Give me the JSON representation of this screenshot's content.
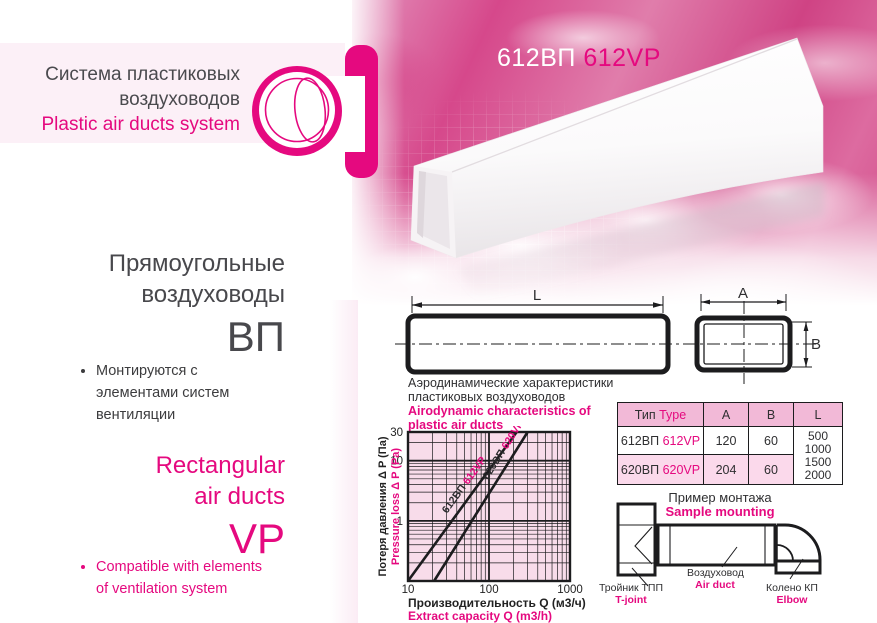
{
  "colors": {
    "accent": "#e5097f",
    "heading": "#48484c",
    "line_dark": "#1c1c1e",
    "plot_bg": "#f8dcea",
    "table_header_bg": "#f2b9d7",
    "table_row_alt_bg": "#fbd9eb",
    "sky_pink": "#d6488b"
  },
  "brand": {
    "title_ru_1": "Система пластиковых",
    "title_ru_2": "воздуховодов",
    "title_en": "Plastic air ducts system"
  },
  "product": {
    "code_ru": "612ВП",
    "code_en": "612VP"
  },
  "left_column": {
    "heading_ru_1": "Прямоугольные",
    "heading_ru_2": "воздуховоды",
    "type_ru": "ВП",
    "bullet_ru": "Монтируются с элементами систем вентиляции",
    "heading_en_1": "Rectangular",
    "heading_en_2": "air ducts",
    "type_en": "VP",
    "bullet_en": "Compatible with elements of ventilation system"
  },
  "dimensions": {
    "length_label": "L",
    "width_label": "A",
    "height_label": "B"
  },
  "chart_data": {
    "type": "line",
    "title_ru": [
      "Аэродинамические характеристики",
      "пластиковых воздуховодов"
    ],
    "title_en": [
      "Airodynamic characteristics of",
      "plastic air ducts"
    ],
    "xlabel_ru": "Производительность Q (м3/ч)",
    "xlabel_en": "Extract capacity Q (m3/h)",
    "ylabel_ru": "Потеря давления Δ P (Па)",
    "ylabel_en": "Pressure loss Δ P (Pa)",
    "x_scale": "log",
    "y_scale": "log",
    "xlim": [
      10,
      1000
    ],
    "ylim": [
      0.1,
      30
    ],
    "x_ticks": [
      "10",
      "100",
      "1000"
    ],
    "y_ticks": [
      {
        "v": 30,
        "label": "30"
      },
      {
        "v": 10,
        "label": "10"
      },
      {
        "v": 1,
        "label": "1"
      }
    ],
    "grid": true,
    "legend_position": "labels-on-lines",
    "series": [
      {
        "name_ru": "612ВП",
        "name_en": "612VP",
        "points": [
          [
            10,
            0.1
          ],
          [
            220,
            30
          ]
        ]
      },
      {
        "name_ru": "620ВП",
        "name_en": "620VP",
        "points": [
          [
            21,
            0.1
          ],
          [
            300,
            30
          ]
        ]
      }
    ]
  },
  "table": {
    "headers": {
      "type_ru": "Тип",
      "type_en": "Type",
      "a": "A",
      "b": "B",
      "l": "L"
    },
    "rows": [
      {
        "ru": "612ВП",
        "en": "612VP",
        "a": "120",
        "b": "60"
      },
      {
        "ru": "620ВП",
        "en": "620VP",
        "a": "204",
        "b": "60"
      }
    ],
    "l_values": [
      "500",
      "1000",
      "1500",
      "2000"
    ]
  },
  "mounting": {
    "title_ru": "Пример монтажа",
    "title_en": "Sample mounting",
    "tjoint_ru": "Тройник ТПП",
    "tjoint_en": "T-joint",
    "duct_ru": "Воздуховод",
    "duct_en": "Air duct",
    "elbow_ru": "Колено КП",
    "elbow_en": "Elbow"
  }
}
